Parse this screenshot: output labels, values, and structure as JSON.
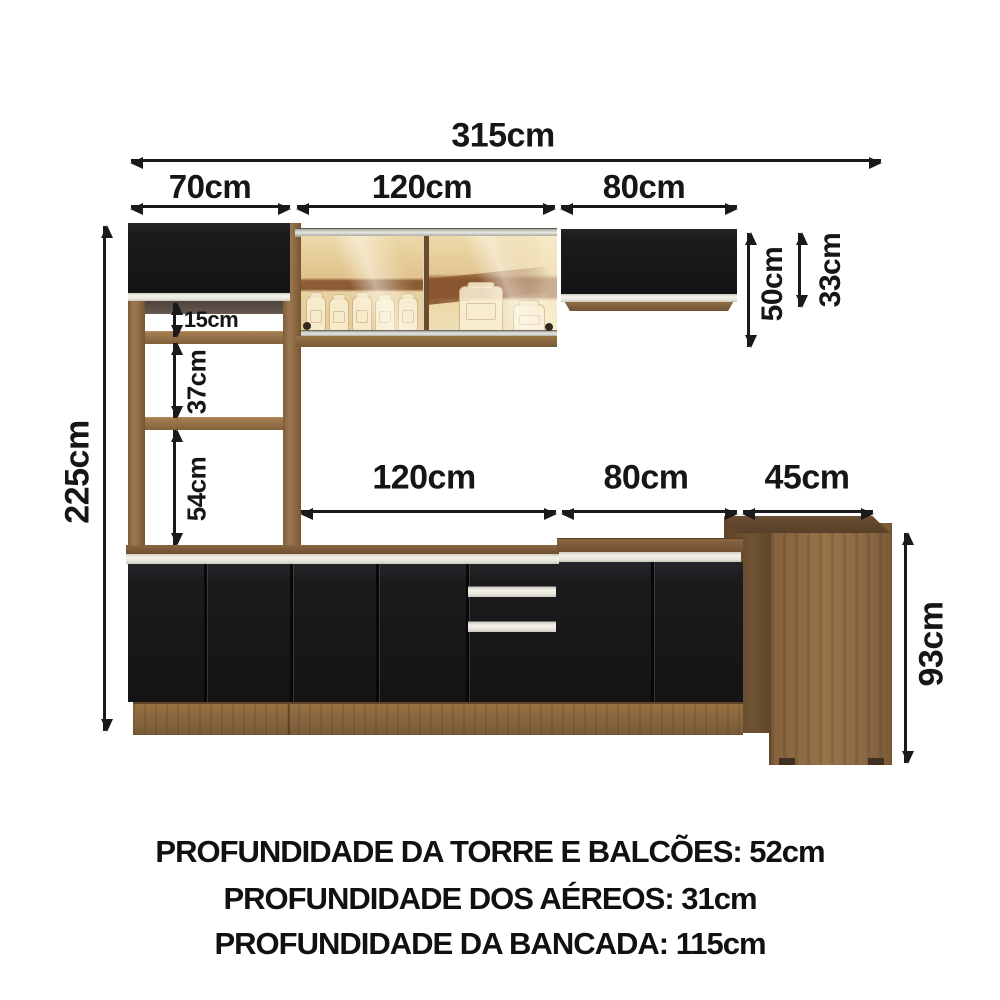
{
  "dims": {
    "total_width": "315cm",
    "tower_width": "70cm",
    "aereo_glass_width": "120cm",
    "aereo_right_width": "80cm",
    "aereo_height_total": "50cm",
    "aereo_door_height": "33cm",
    "total_height": "225cm",
    "shelf_gap_1": "15cm",
    "shelf_gap_2": "37cm",
    "shelf_gap_3": "54cm",
    "balcao_1_width": "120cm",
    "balcao_2_width": "80cm",
    "bancada_width": "45cm",
    "bancada_height": "93cm"
  },
  "footer": {
    "line_1": "PROFUNDIDADE DA TORRE E BALCÕES: 52cm",
    "line_2": "PROFUNDIDADE DOS AÉREOS: 31cm",
    "line_3": "PROFUNDIDADE DA BANCADA: 115cm"
  },
  "colors": {
    "arrow": "#1a1a1a",
    "cabinet_black": "#1b1b1d",
    "handle_cream": "#e9e6dc",
    "wood_medium": "#8f6c45",
    "wood_dark": "#6b4e31",
    "bancada_top": "#5f452c",
    "glass_amber_light": "#ecd9a8",
    "glass_amber_dark": "#8f5e35",
    "background": "#ffffff"
  }
}
